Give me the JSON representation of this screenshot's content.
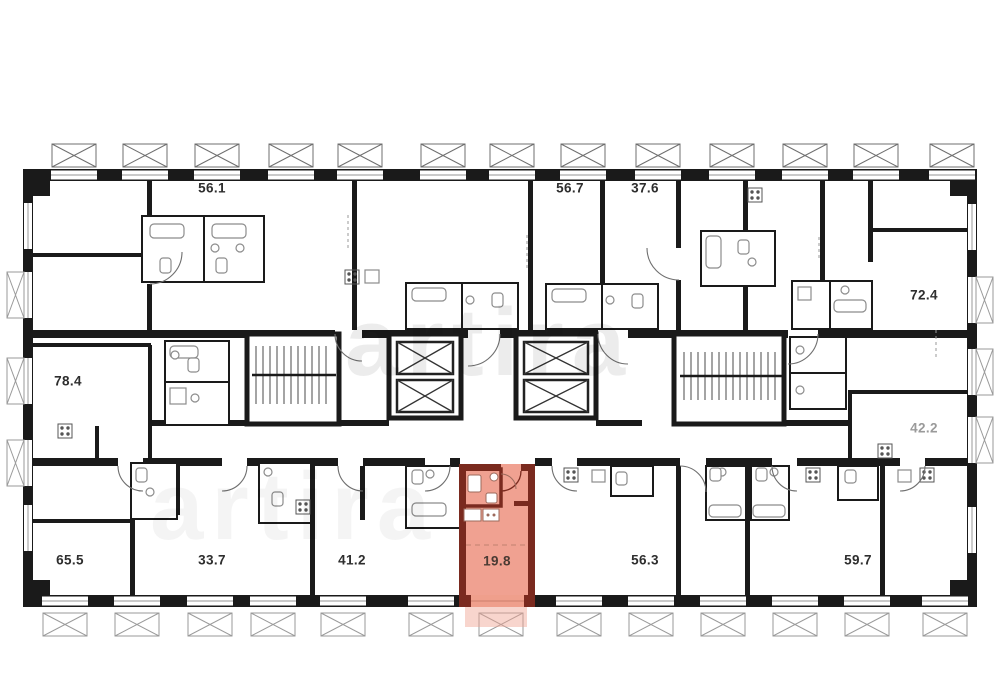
{
  "plan": {
    "type": "residential-floor-plan",
    "highlighted_unit": {
      "label": "19.8",
      "fill": "#f0a191",
      "wall_color": "#7a2a1f"
    },
    "units": [
      {
        "label": "56.1"
      },
      {
        "label": "56.7"
      },
      {
        "label": "37.6"
      },
      {
        "label": "72.4"
      },
      {
        "label": "78.4"
      },
      {
        "label": "42.2"
      },
      {
        "label": "65.5"
      },
      {
        "label": "33.7"
      },
      {
        "label": "41.2"
      },
      {
        "label": "19.8",
        "highlighted": true
      },
      {
        "label": "56.3"
      },
      {
        "label": "59.7"
      }
    ],
    "colors": {
      "wall": "#1a1a1a",
      "fixture": "#8c8c8c",
      "highlight_fill": "#f0a191",
      "highlight_wall": "#7a2a1f",
      "watermark": "#e8e8e8"
    }
  },
  "watermark": {
    "text": "artira"
  }
}
